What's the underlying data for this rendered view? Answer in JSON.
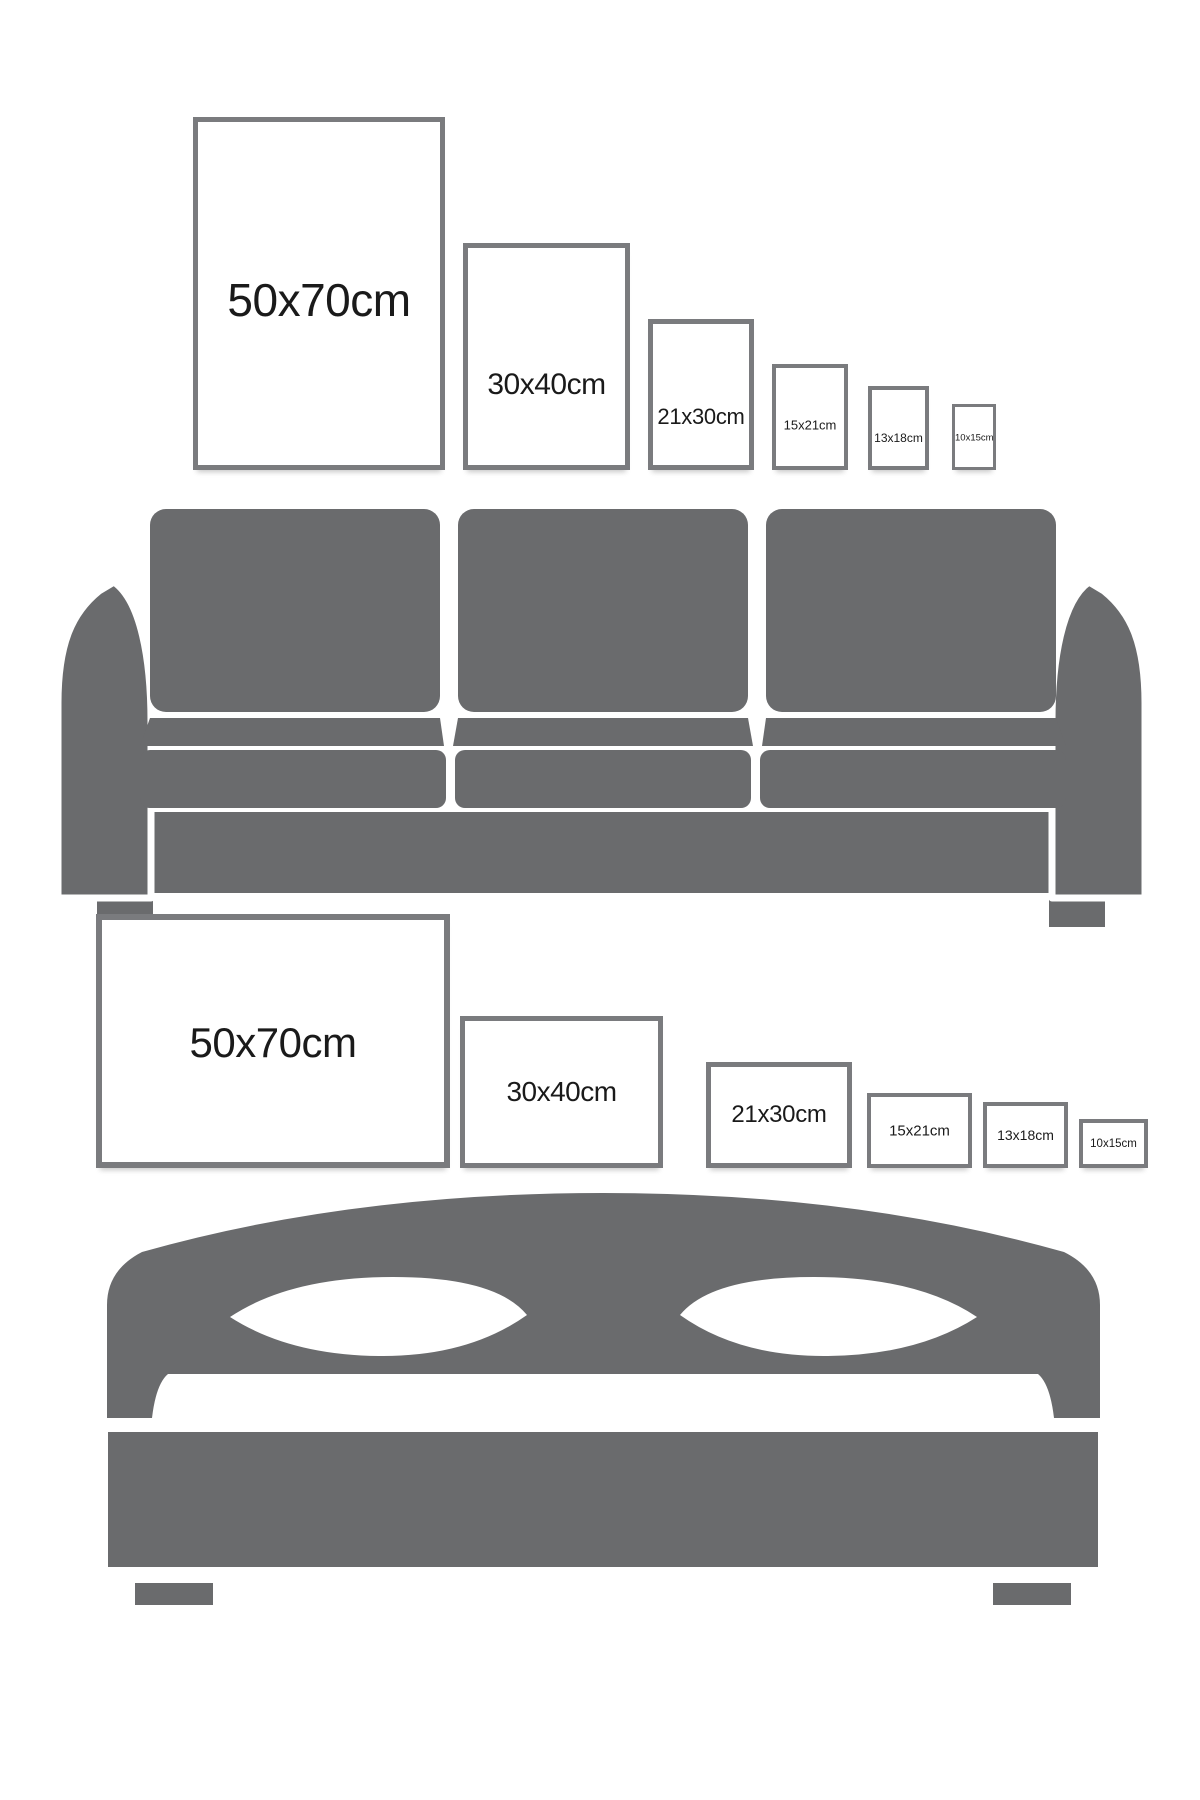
{
  "colors": {
    "furniture_gray": "#6a6b6d",
    "frame_border": "#7a7b7e",
    "label_text": "#1a1a1a",
    "background": "#ffffff"
  },
  "sections": [
    {
      "id": "portrait-sizes-over-sofa",
      "furniture": "sofa-icon",
      "orientation": "portrait",
      "frames": [
        {
          "label": "50x70cm"
        },
        {
          "label": "30x40cm"
        },
        {
          "label": "21x30cm"
        },
        {
          "label": "15x21cm"
        },
        {
          "label": "13x18cm"
        },
        {
          "label": "10x15cm"
        }
      ]
    },
    {
      "id": "landscape-sizes-over-bed",
      "furniture": "bed-icon",
      "orientation": "landscape",
      "frames": [
        {
          "label": "50x70cm"
        },
        {
          "label": "30x40cm"
        },
        {
          "label": "21x30cm"
        },
        {
          "label": "15x21cm"
        },
        {
          "label": "13x18cm"
        },
        {
          "label": "10x15cm"
        }
      ]
    }
  ]
}
